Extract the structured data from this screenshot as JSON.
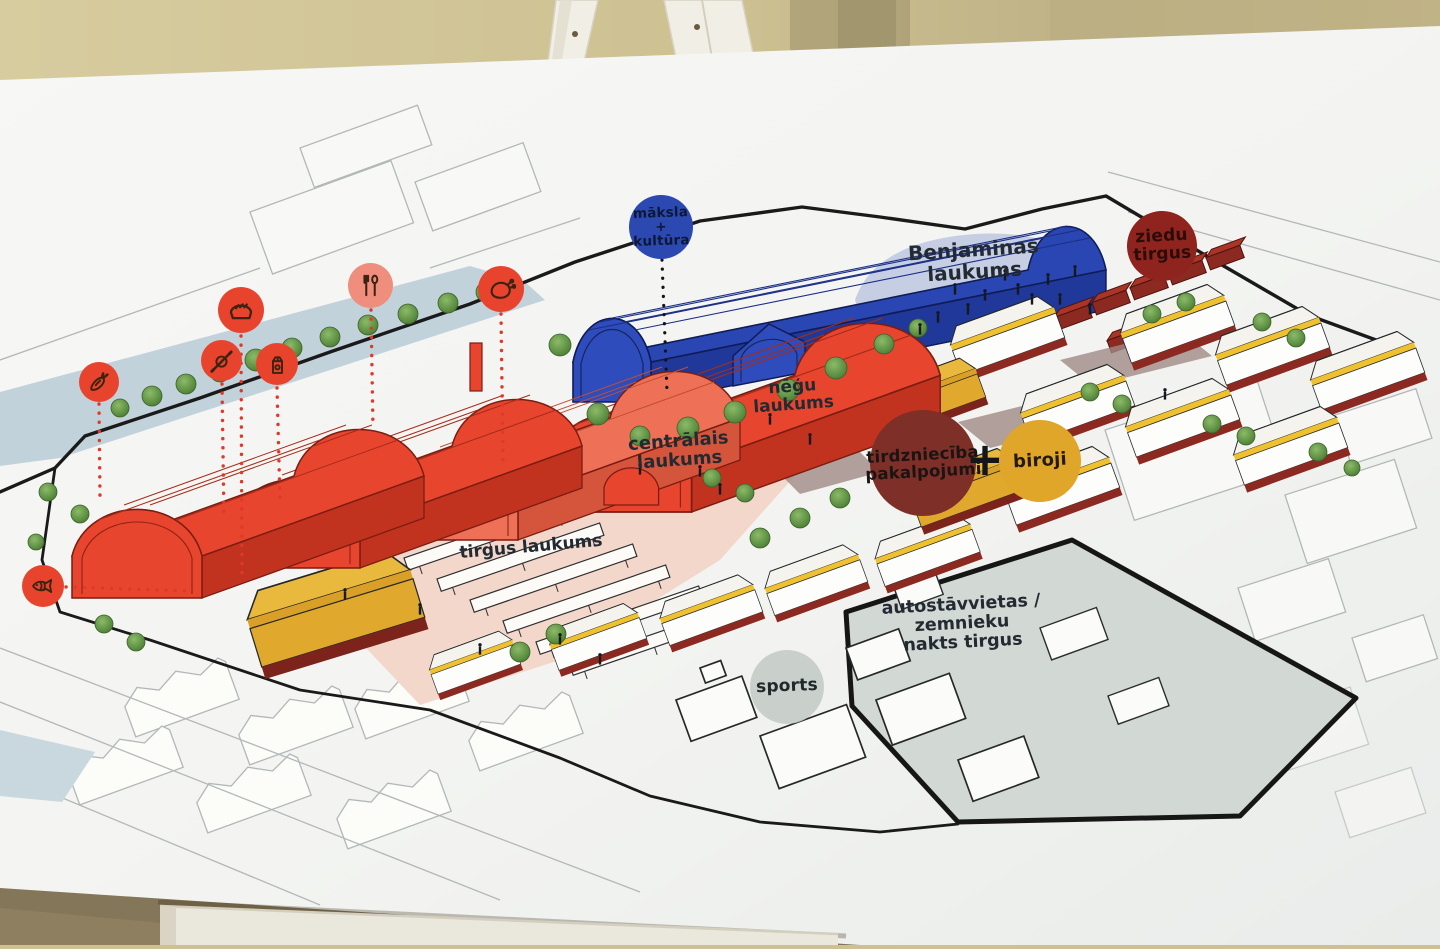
{
  "scene": {
    "description_labels": [],
    "palette": {
      "wall_beige": "#cdc192",
      "board_white": "#f4f4f1",
      "market_hall_red": "#e8452e",
      "market_hall_red_light": "#ee7056",
      "culture_blue": "#2a46b2",
      "gold": "#dfa62a",
      "dark_red_stalls": "#8c2a22",
      "maroon_circle": "#7d2f28",
      "ziedu_circle_red": "#8f231e",
      "plaza_pink": "#f3d7cb",
      "plaza_blue": "#c5cee3",
      "parking_gray": "#d2d8d4",
      "sports_gray": "#c9d1cd",
      "icon_circle_red": "#e8432c",
      "icon_circle_salmon": "#ef8e7d",
      "outline_city_gray": "#b2b8b8",
      "label_text": "#232a31"
    }
  },
  "map": {
    "badges": [
      {
        "id": "maksla-kultura",
        "label": "māksla\n+\nkultūra"
      },
      {
        "id": "ziedu-tirgus",
        "label": "ziedu\ntirgus"
      },
      {
        "id": "tirdznieciba-pakalpojumi",
        "label": "tirdzniecība\npakalpojumi"
      },
      {
        "id": "plus-sign",
        "label": "+"
      },
      {
        "id": "biroji",
        "label": "biroji"
      },
      {
        "id": "sports",
        "label": "sports"
      }
    ],
    "area_labels": [
      {
        "id": "benjaminas-laukums",
        "label": "Benjaminas\nlaukums"
      },
      {
        "id": "negu-laukums",
        "label": "nēģu\nlaukums"
      },
      {
        "id": "centralais-laukums",
        "label": "centrālais\nlaukums"
      },
      {
        "id": "tirgus-laukums",
        "label": "tirgus laukums"
      },
      {
        "id": "autostavvietas",
        "label": "autostāvvietas /\nzemnieku\nnakts tirgus"
      }
    ],
    "legend_icons": [
      "carrot",
      "bread",
      "pastry-rolling-pin",
      "milk-carton",
      "fork-and-spoon",
      "poultry",
      "fish"
    ]
  }
}
